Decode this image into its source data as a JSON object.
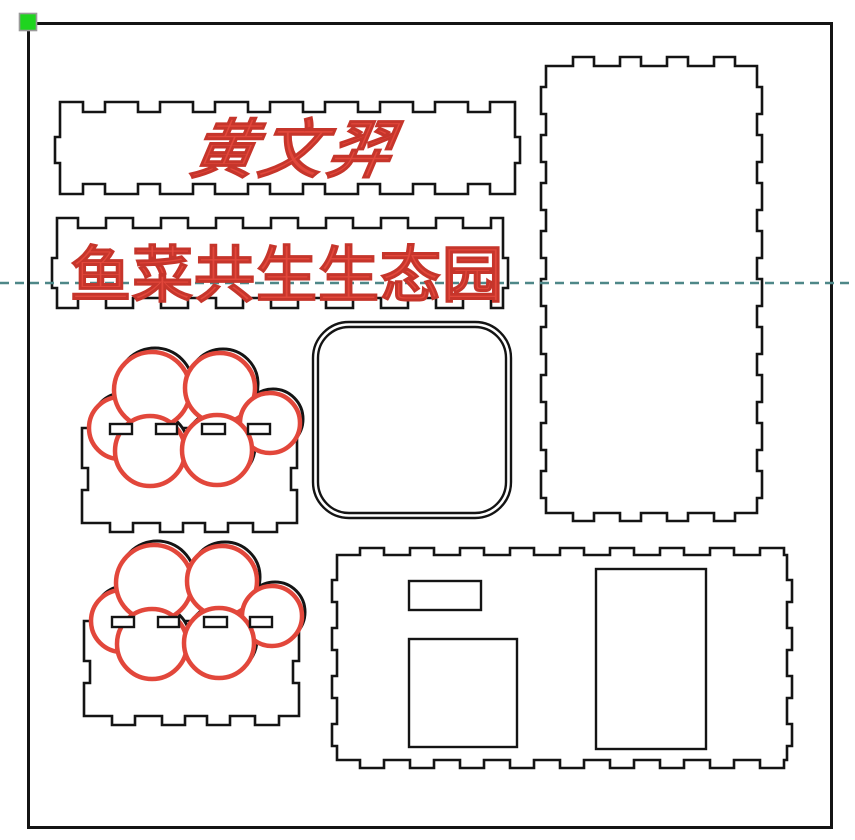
{
  "design": {
    "name_plate_text": "黄文羿",
    "title_plate_text": "鱼菜共生生态园"
  },
  "colors": {
    "outline_black": "#141414",
    "engrave_red": "#e2473b",
    "engrave_red_dark": "#c6352b",
    "guide_teal": "#4e8788",
    "handle_green": "#1fd41f",
    "handle_border_gray": "#9a9a9a"
  }
}
